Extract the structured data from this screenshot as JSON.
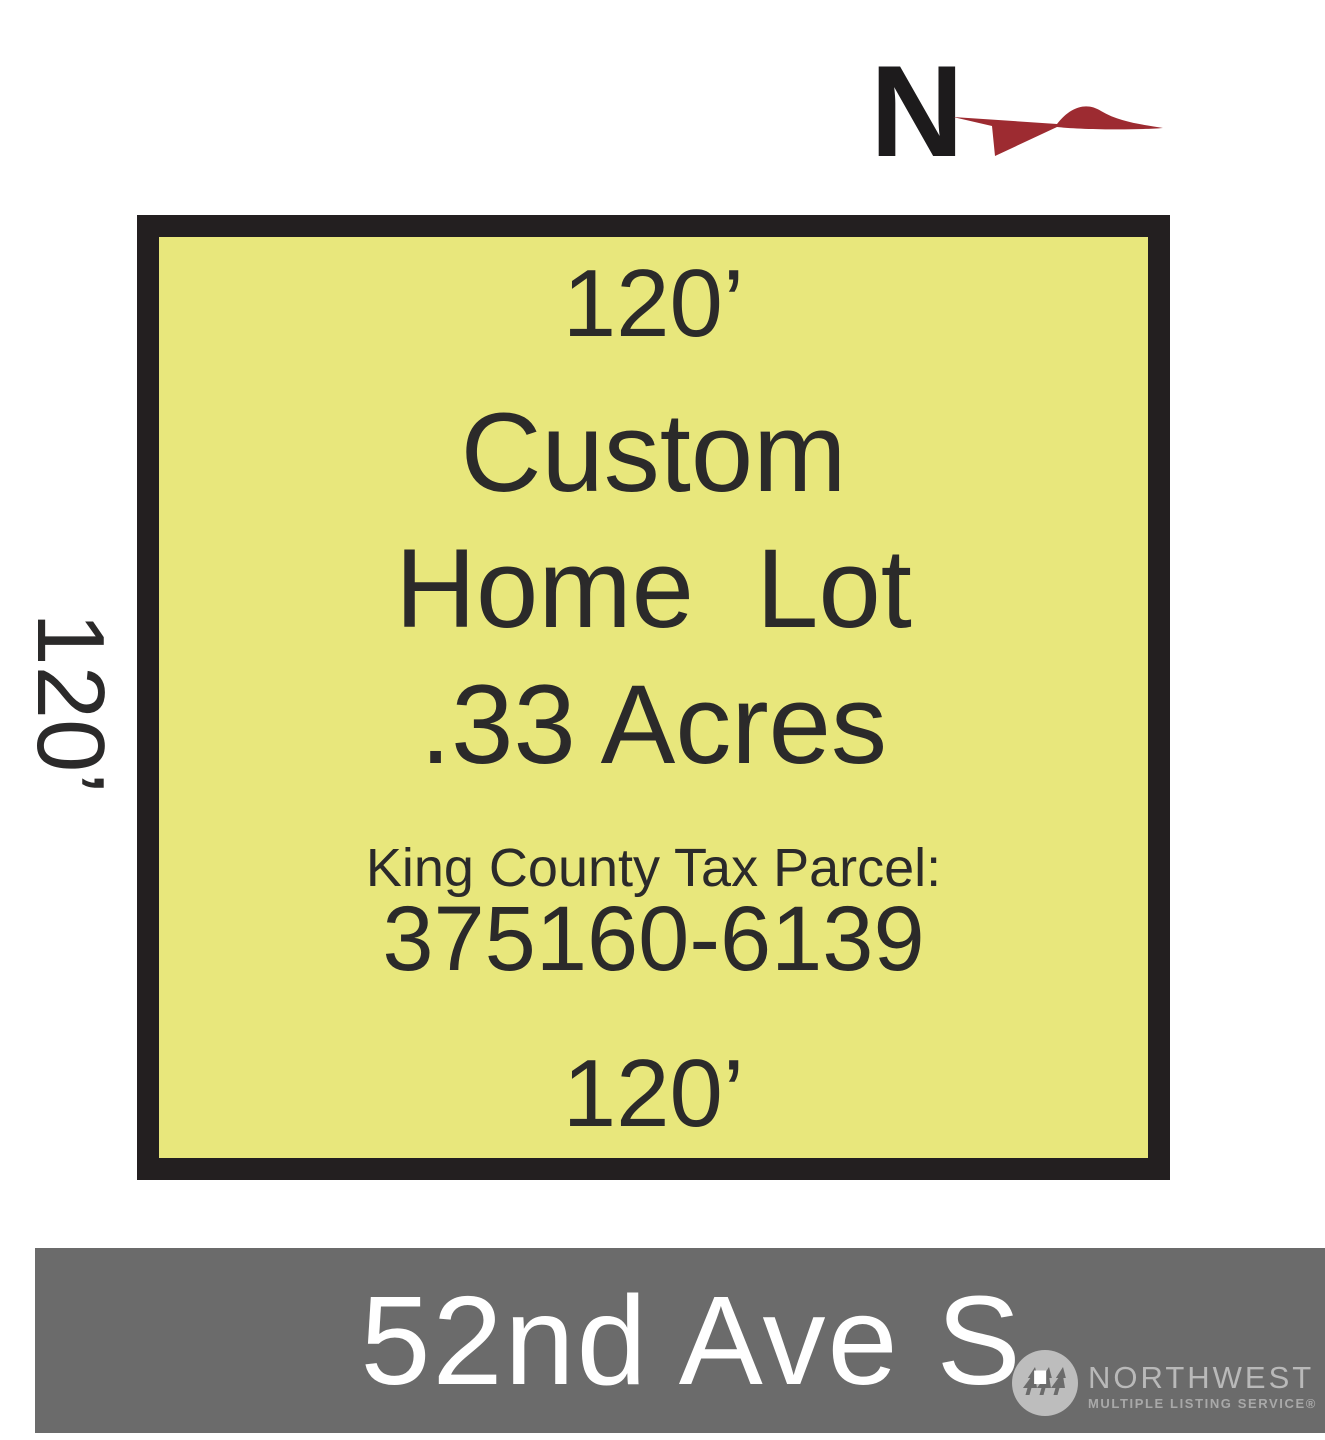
{
  "north": {
    "label": "N",
    "arrow_color": "#9d2b31",
    "letter_color": "#1d1b1c"
  },
  "lot": {
    "fill_color": "#e8e77c",
    "border_color": "#231f20",
    "text_color": "#2b2a2a",
    "top_dimension": "120’",
    "left_dimension": "120’",
    "bottom_dimension": "120’",
    "title_line1": "Custom",
    "title_line2": "Home  Lot",
    "title_line3": ".33 Acres",
    "parcel_label": "King County Tax Parcel:",
    "parcel_number": "375160-6139",
    "acreage": ".33",
    "frontage_feet": 120,
    "depth_feet": 120
  },
  "street": {
    "name": "52nd Ave S.",
    "bar_color": "#6b6b6b",
    "text_color": "#ffffff"
  },
  "watermark": {
    "line1": "NORTHWEST",
    "line2": "MULTIPLE LISTING SERVICE®",
    "icon": "nwmls-trees-circle-icon",
    "color": "#b9b9b9"
  }
}
